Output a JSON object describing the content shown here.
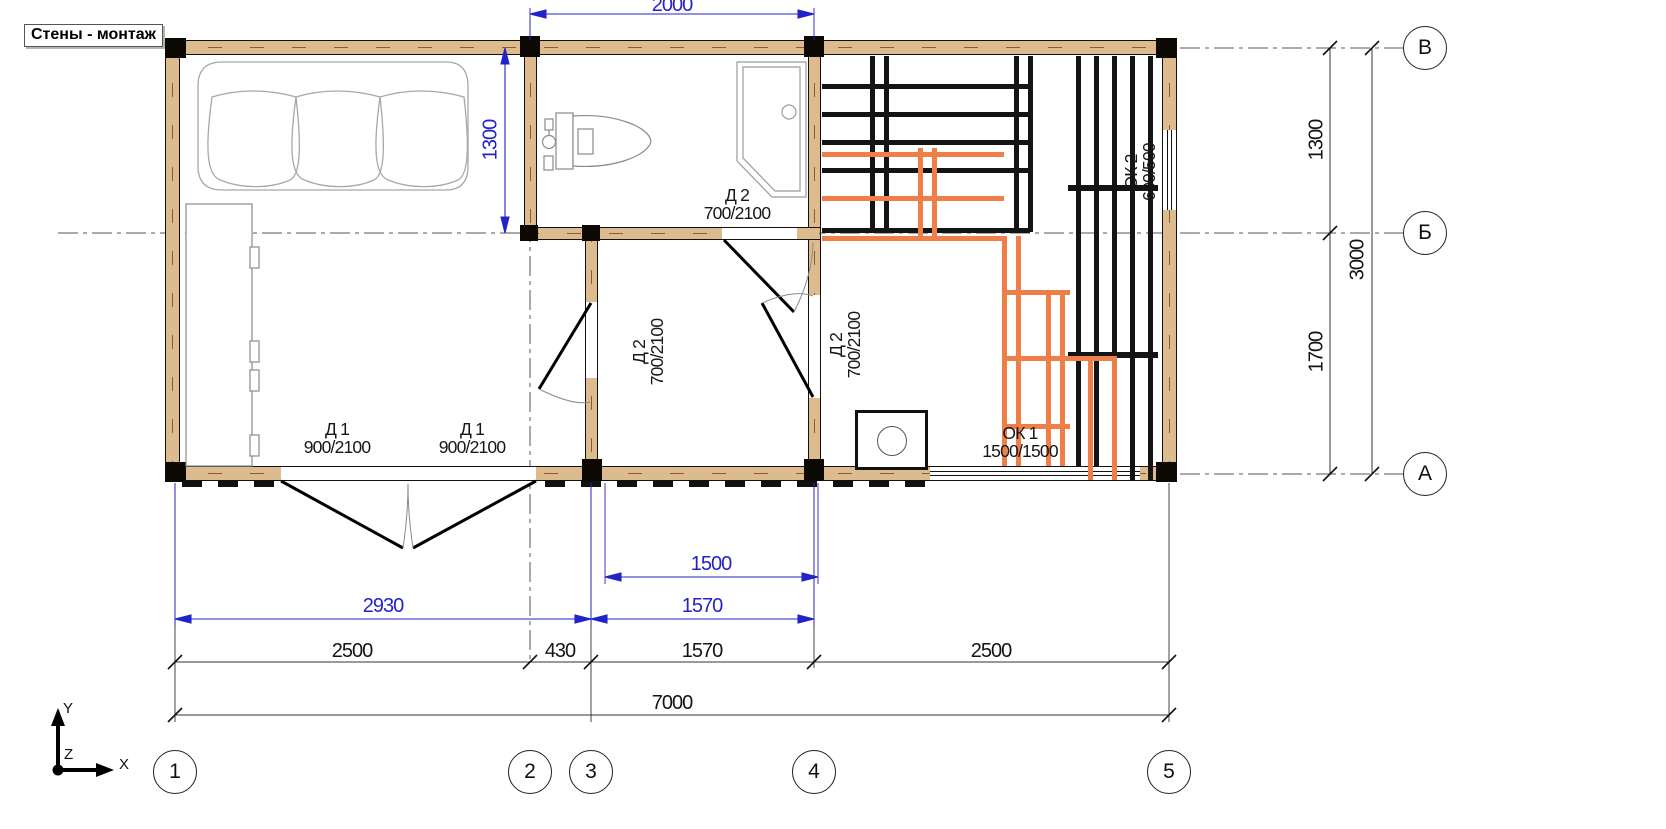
{
  "title": "Стены - монтаж",
  "doors": {
    "d1_left": {
      "name": "Д 1",
      "size": "900/2100"
    },
    "d1_right": {
      "name": "Д 1",
      "size": "900/2100"
    },
    "d2_bath": {
      "name": "Д 2",
      "size": "700/2100"
    },
    "d2_hall_left": {
      "name": "Д 2",
      "size": "700/2100"
    },
    "d2_hall_right": {
      "name": "Д 2",
      "size": "700/2100"
    }
  },
  "windows": {
    "ok1": {
      "name": "ОК 1",
      "size": "1500/1500"
    },
    "ok2": {
      "name": "ОК 2",
      "size": "600/500"
    }
  },
  "dims": {
    "blue": {
      "top": "2000",
      "bath": "1300",
      "hall_clear": "1500",
      "hall": "1570",
      "entry": "2930"
    },
    "row1": [
      "2500",
      "430",
      "1570",
      "2500"
    ],
    "total": "7000",
    "right": {
      "upper": "1300",
      "lower": "1700",
      "total": "3000"
    }
  },
  "grid": {
    "cols": [
      "1",
      "2",
      "3",
      "4",
      "5"
    ],
    "rows": [
      "В",
      "Б",
      "А"
    ]
  },
  "ucs": {
    "x": "X",
    "y": "Y",
    "z": "Z"
  },
  "colors": {
    "dim_blue": "#2323c8",
    "wall_tan": "#dcbb8f",
    "bench_orange": "#ee7f49"
  }
}
